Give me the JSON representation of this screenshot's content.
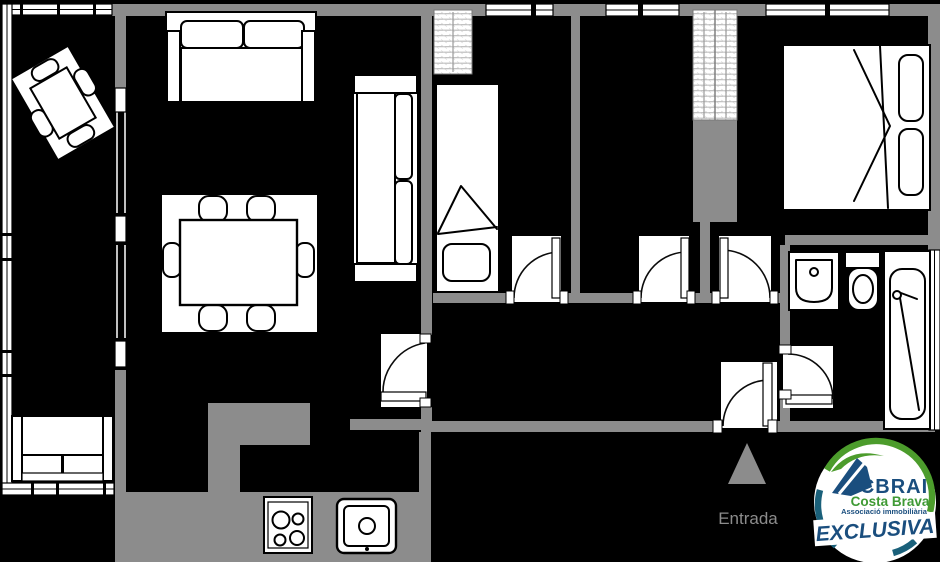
{
  "plan": {
    "background_color": "#000000",
    "wall_color": "#8c8c8c",
    "outline_color": "#000000",
    "furniture_fill": "#ffffff",
    "wardrobe_hatch_color": "#b8b8b8",
    "entrance": {
      "label": "Entrada",
      "marker": "up-triangle",
      "color": "#8c8c8c"
    }
  },
  "logo": {
    "brand": "CBRAI",
    "region": "Costa Brava",
    "association": "Associació immobiliària",
    "banner": "EXCLUSIVA",
    "colors": {
      "green": "#4c9c2c",
      "navy": "#1a4e7e",
      "teal": "#1a607a"
    }
  }
}
